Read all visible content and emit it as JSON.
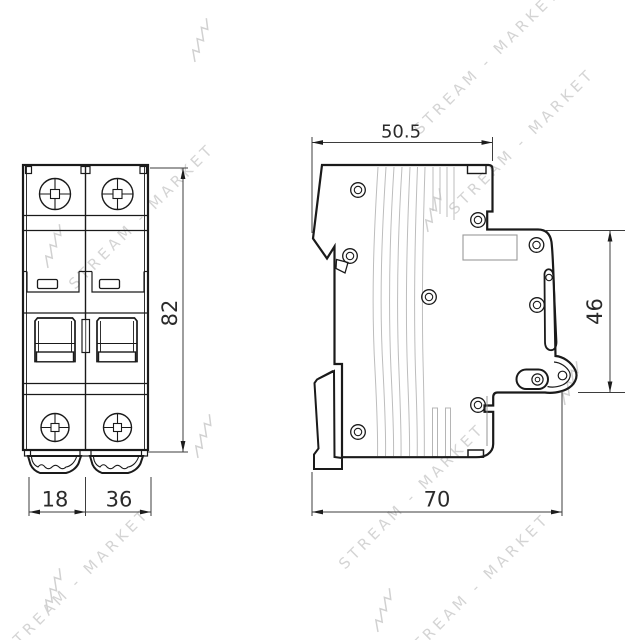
{
  "watermark": {
    "text": "STREAM - MARKET",
    "color": "#cdcdcd"
  },
  "dimensions": {
    "front_height": "82",
    "pole_width": "18",
    "total_width": "36",
    "side_top_depth": "50.5",
    "side_front_height": "46",
    "side_total_depth": "70"
  },
  "colors": {
    "outline": "#1a1a1a",
    "dimension_line": "#3d3d3d",
    "mold_line": "#bdbdbd",
    "watermark": "#cdcdcd",
    "background": "#ffffff"
  }
}
